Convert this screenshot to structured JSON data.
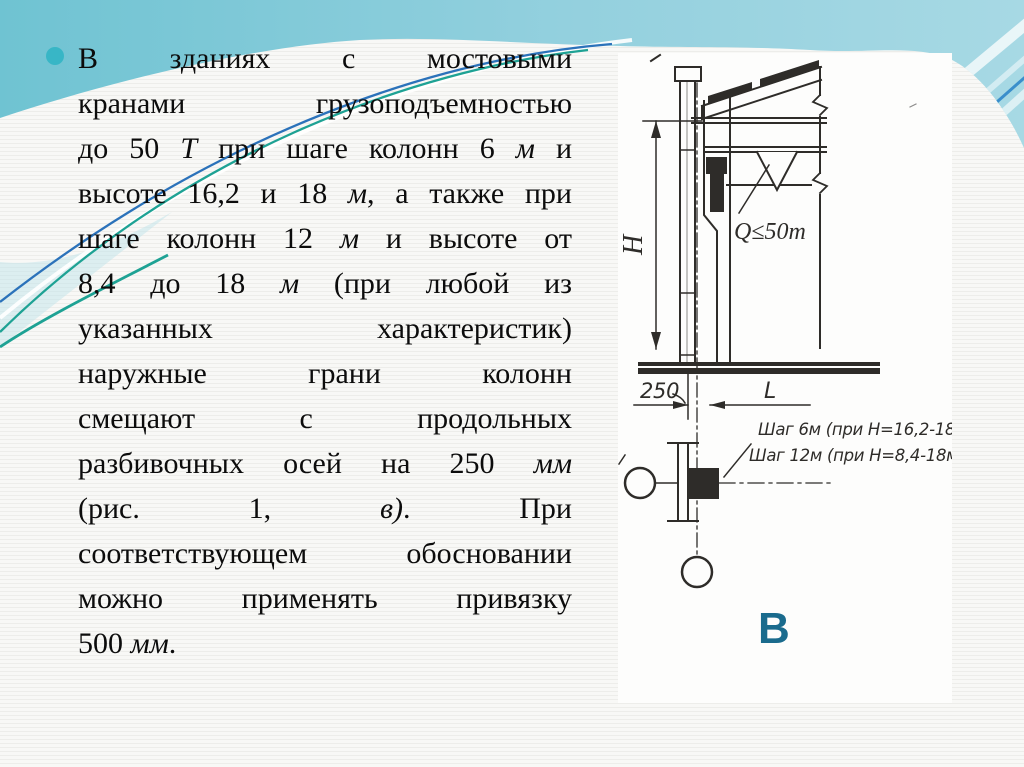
{
  "colors": {
    "slide_bg": "#f8f8f6",
    "band_from": "#6fc3d2",
    "band_to": "#a7d9e4",
    "accent_blue": "#2b72ba",
    "accent_green": "#1ea294",
    "bullet": "#38b6c6",
    "letter": "#1a6b8d",
    "ink": "#2e2c29",
    "paper": "#fdfdfc"
  },
  "bullet_text": {
    "lines": [
      {
        "justify": true,
        "segments": [
          {
            "text": "В зданиях с мостовыми",
            "italic": false
          }
        ]
      },
      {
        "justify": true,
        "segments": [
          {
            "text": "кранами грузоподъемностью",
            "italic": false
          }
        ]
      },
      {
        "justify": true,
        "segments": [
          {
            "text": "до 50 ",
            "italic": false
          },
          {
            "text": "Т",
            "italic": true
          },
          {
            "text": " при шаге колонн 6 ",
            "italic": false
          },
          {
            "text": "м",
            "italic": true
          },
          {
            "text": " и",
            "italic": false
          }
        ]
      },
      {
        "justify": true,
        "segments": [
          {
            "text": "высоте 16,2 и 18 ",
            "italic": false
          },
          {
            "text": "м",
            "italic": true
          },
          {
            "text": ", а также при",
            "italic": false
          }
        ]
      },
      {
        "justify": true,
        "segments": [
          {
            "text": "шаге колонн 12 ",
            "italic": false
          },
          {
            "text": "м",
            "italic": true
          },
          {
            "text": " и высоте от",
            "italic": false
          }
        ]
      },
      {
        "justify": true,
        "segments": [
          {
            "text": "8,4 до 18 ",
            "italic": false
          },
          {
            "text": "м",
            "italic": true
          },
          {
            "text": " (при любой из",
            "italic": false
          }
        ]
      },
      {
        "justify": true,
        "segments": [
          {
            "text": "указанных характеристик)",
            "italic": false
          }
        ]
      },
      {
        "justify": true,
        "segments": [
          {
            "text": "наружные грани колонн",
            "italic": false
          }
        ]
      },
      {
        "justify": true,
        "segments": [
          {
            "text": "смещают с продольных",
            "italic": false
          }
        ]
      },
      {
        "justify": true,
        "segments": [
          {
            "text": "разбивочных осей на 250 ",
            "italic": false
          },
          {
            "text": "мм",
            "italic": true
          }
        ]
      },
      {
        "justify": true,
        "segments": [
          {
            "text": "(рис. 1, ",
            "italic": false
          },
          {
            "text": "в)",
            "italic": true
          },
          {
            "text": ". При",
            "italic": false
          }
        ]
      },
      {
        "justify": true,
        "segments": [
          {
            "text": "соответствующем обосновании",
            "italic": false
          }
        ]
      },
      {
        "justify": true,
        "segments": [
          {
            "text": "можно применять привязку",
            "italic": false
          }
        ]
      },
      {
        "justify": false,
        "segments": [
          {
            "text": "500 ",
            "italic": false
          },
          {
            "text": "мм",
            "italic": true
          },
          {
            "text": ".",
            "italic": false
          }
        ]
      }
    ]
  },
  "figure": {
    "labels": {
      "height_dim": "H",
      "crane_capacity": "Q≤50т",
      "offset_dim": "250",
      "span_dim": "L",
      "step_note_1": "Шаг 6м (при Н=16,2-18м)",
      "step_note_2": "Шаг 12м (при Н=8,4-18м)",
      "variant_letter": "В"
    }
  }
}
